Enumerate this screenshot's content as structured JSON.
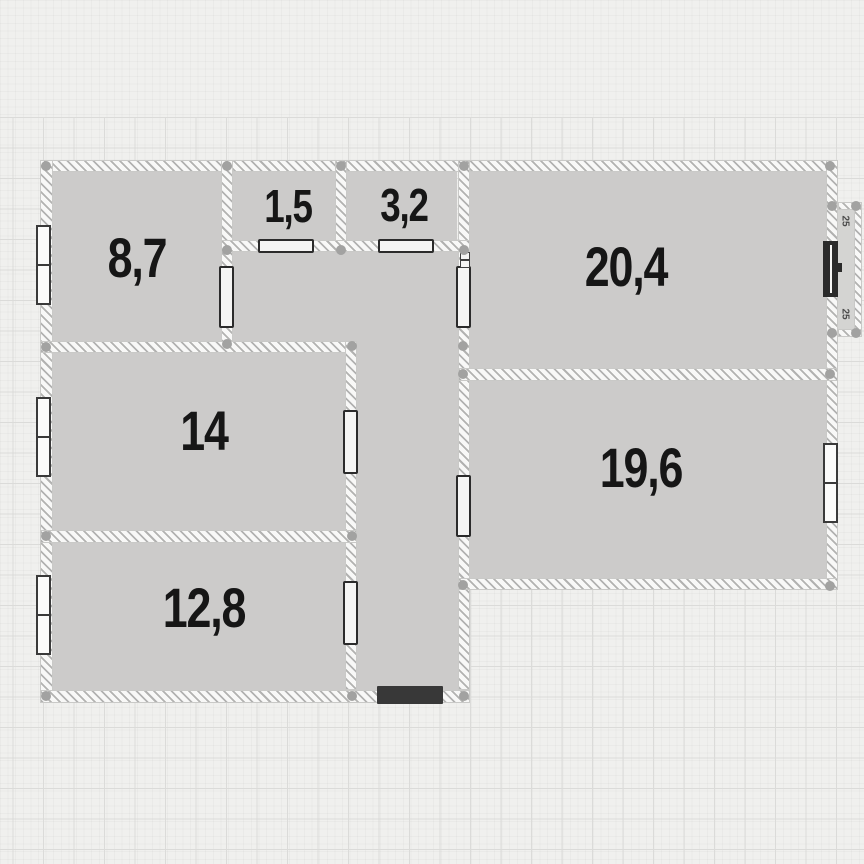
{
  "plan": {
    "title": "apartment-floor-plan",
    "rooms": [
      {
        "id": "room-8-7",
        "area": "8,7"
      },
      {
        "id": "room-1-5",
        "area": "1,5"
      },
      {
        "id": "room-3-2",
        "area": "3,2"
      },
      {
        "id": "room-20-4",
        "area": "20,4"
      },
      {
        "id": "room-14",
        "area": "14"
      },
      {
        "id": "room-19-6",
        "area": "19,6"
      },
      {
        "id": "room-12-8",
        "area": "12,8"
      }
    ],
    "balcony": {
      "top_mark": "25",
      "bottom_mark": "25"
    },
    "colors": {
      "background": "#f0f0ee",
      "room_fill": "#cccbca",
      "wall_hatch": "#b2b2b1",
      "grid_line": "#dbdbd9",
      "door_outline": "#2b2b2b",
      "entry_door_fill": "#383838",
      "joint_dot": "#a2a2a1",
      "label_text": "#161616"
    }
  }
}
